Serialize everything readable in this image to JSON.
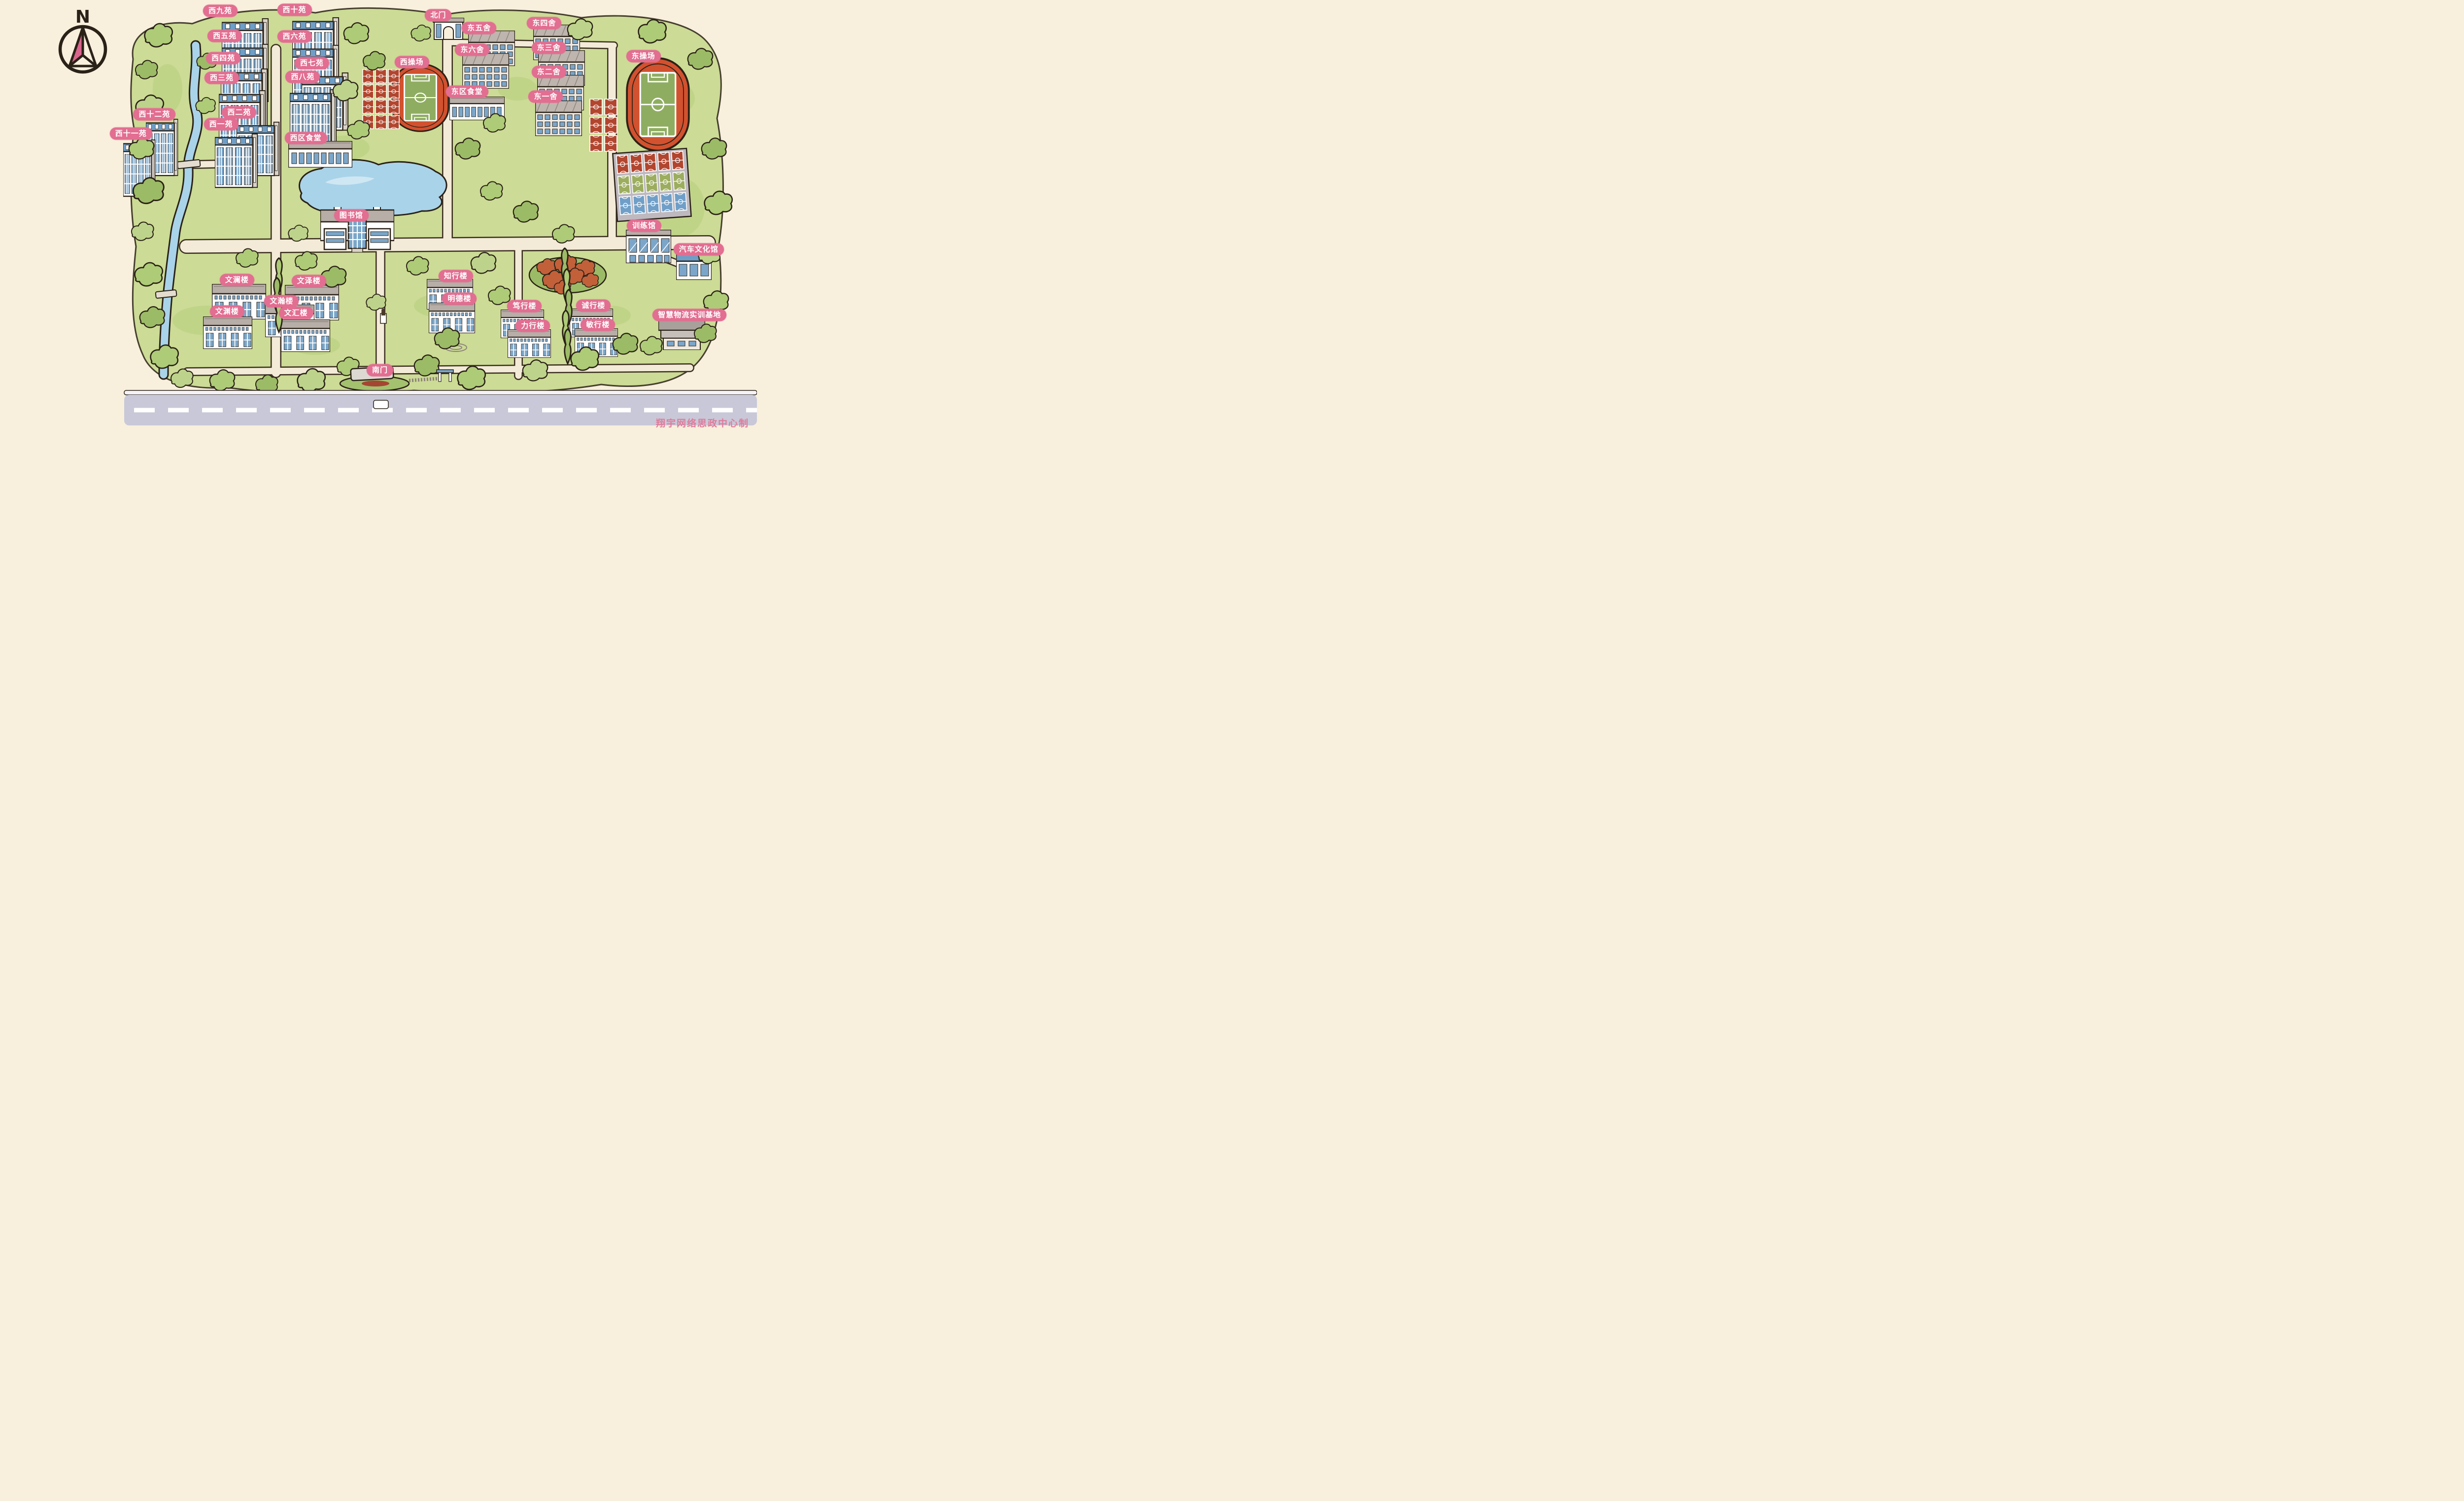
{
  "map": {
    "compass_label": "N",
    "credit": "翔宇网络思政中心制",
    "colors": {
      "background": "#f8efdd",
      "campus_green": "#ccdb95",
      "tree_green": "#aecb77",
      "badge_pink": "#e26e91",
      "badge_text": "#ffffff",
      "track_orange": "#d2512e",
      "field_green": "#8fad61",
      "court_red": "#b2452e",
      "court_green": "#9cad5e",
      "court_blue": "#6f9fc8",
      "building_blue": "#7ba6c9",
      "roof_blue": "#6f9ec6",
      "roof_gray": "#b6aea7",
      "water_blue": "#a9d3e9",
      "road_beige": "#f3ebd8",
      "highway_gray": "#c8c8d8",
      "ink": "#2a2117",
      "autumn_red": "#c2603a"
    },
    "labels": [
      {
        "id": "xi-jiu-yuan",
        "text": "西九苑",
        "x": 29.1,
        "y": 2.5
      },
      {
        "id": "xi-shi-yuan",
        "text": "西十苑",
        "x": 38.9,
        "y": 2.3
      },
      {
        "id": "xi-wu-yuan",
        "text": "西五苑",
        "x": 29.7,
        "y": 8.4
      },
      {
        "id": "xi-liu-yuan",
        "text": "西六苑",
        "x": 38.9,
        "y": 8.5
      },
      {
        "id": "xi-si-yuan",
        "text": "西四苑",
        "x": 29.5,
        "y": 13.5
      },
      {
        "id": "xi-qi-yuan",
        "text": "西七苑",
        "x": 41.2,
        "y": 14.7
      },
      {
        "id": "xi-san-yuan",
        "text": "西三苑",
        "x": 29.3,
        "y": 18.1
      },
      {
        "id": "xi-ba-yuan",
        "text": "西八苑",
        "x": 40.0,
        "y": 17.9
      },
      {
        "id": "xi-er-yuan",
        "text": "西二苑",
        "x": 31.6,
        "y": 26.1
      },
      {
        "id": "xi-yi-yuan",
        "text": "西一苑",
        "x": 29.2,
        "y": 28.9
      },
      {
        "id": "xi-shier-yuan",
        "text": "西十二苑",
        "x": 20.4,
        "y": 26.6
      },
      {
        "id": "xi-shiyi-yuan",
        "text": "西十一苑",
        "x": 17.3,
        "y": 31.0
      },
      {
        "id": "xiqu-shitang",
        "text": "西区食堂",
        "x": 40.4,
        "y": 32.1
      },
      {
        "id": "bei-men",
        "text": "北门",
        "x": 57.9,
        "y": 3.6
      },
      {
        "id": "dong-wu-she",
        "text": "东五舍",
        "x": 63.3,
        "y": 6.5
      },
      {
        "id": "dong-si-she",
        "text": "东四舍",
        "x": 71.9,
        "y": 5.4
      },
      {
        "id": "dong-liu-she",
        "text": "东六舍",
        "x": 62.4,
        "y": 11.6
      },
      {
        "id": "dong-san-she",
        "text": "东三舍",
        "x": 72.5,
        "y": 11.1
      },
      {
        "id": "dong-er-she",
        "text": "东二舍",
        "x": 72.5,
        "y": 16.7
      },
      {
        "id": "dong-yi-she",
        "text": "东一舍",
        "x": 72.1,
        "y": 22.5
      },
      {
        "id": "xi-caochang",
        "text": "西操场",
        "x": 54.4,
        "y": 14.4
      },
      {
        "id": "dong-caochang",
        "text": "东操场",
        "x": 85.0,
        "y": 13.1
      },
      {
        "id": "dongqu-shitang",
        "text": "东区食堂",
        "x": 61.7,
        "y": 21.3
      },
      {
        "id": "tushuguan",
        "text": "图书馆",
        "x": 46.4,
        "y": 50.1
      },
      {
        "id": "xunlianguan",
        "text": "训练馆",
        "x": 85.1,
        "y": 52.5
      },
      {
        "id": "qiche-wenhuaguan",
        "text": "汽车文化馆",
        "x": 92.3,
        "y": 58.0
      },
      {
        "id": "wenlan-lou",
        "text": "文澜楼",
        "x": 31.3,
        "y": 65.1
      },
      {
        "id": "wenze-lou",
        "text": "文泽楼",
        "x": 40.8,
        "y": 65.3
      },
      {
        "id": "wenhan-lou",
        "text": "文瀚楼",
        "x": 37.2,
        "y": 70.0
      },
      {
        "id": "wenyuan-lou",
        "text": "文渊楼",
        "x": 30.0,
        "y": 72.4
      },
      {
        "id": "wenhui-lou",
        "text": "文汇楼",
        "x": 39.1,
        "y": 72.7
      },
      {
        "id": "zhixing-lou",
        "text": "知行楼",
        "x": 60.2,
        "y": 64.1
      },
      {
        "id": "mingde-lou",
        "text": "明德楼",
        "x": 60.7,
        "y": 69.4
      },
      {
        "id": "duxing-lou",
        "text": "笃行楼",
        "x": 69.3,
        "y": 71.1
      },
      {
        "id": "chengxing-lou",
        "text": "诚行楼",
        "x": 78.4,
        "y": 71.0
      },
      {
        "id": "lixing-lou",
        "text": "力行楼",
        "x": 70.4,
        "y": 75.7
      },
      {
        "id": "minxing-lou",
        "text": "敏行楼",
        "x": 79.0,
        "y": 75.5
      },
      {
        "id": "zhihui-wuliu-jidi",
        "text": "智慧物流实训基地",
        "x": 91.1,
        "y": 73.2
      },
      {
        "id": "nan-men",
        "text": "南门",
        "x": 50.2,
        "y": 86.0
      }
    ]
  }
}
